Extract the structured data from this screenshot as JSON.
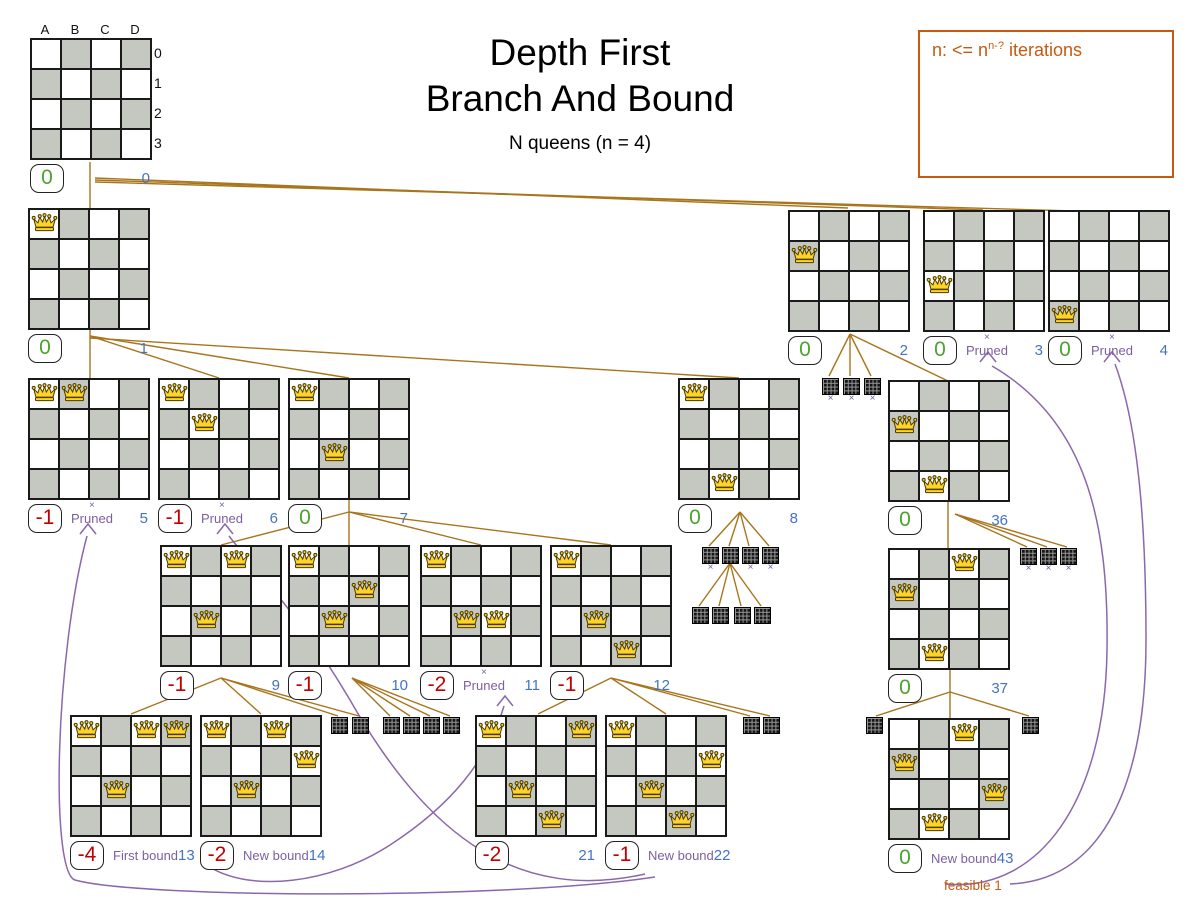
{
  "title": {
    "line1": "Depth First",
    "line2": "Branch And Bound",
    "subtitle": "N queens (n = 4)"
  },
  "legend": {
    "prefix": "n: <= n",
    "sup": "n-?",
    "suffix": " iterations"
  },
  "axis": {
    "cols": [
      "A",
      "B",
      "C",
      "D"
    ],
    "rows": [
      "0",
      "1",
      "2",
      "3"
    ]
  },
  "colors": {
    "edge": "#a9751c",
    "purple": "#8a68ab",
    "labelpurple": "#7d5fa0",
    "blue": "#4472c4",
    "green": "#4ca32e",
    "red": "#c00000",
    "orange": "#c55a11",
    "gray": "#c4c8c0"
  },
  "nodes": [
    {
      "id": "0",
      "x": 30,
      "y": 22,
      "queens": [],
      "score": "0",
      "axes": true
    },
    {
      "id": "1",
      "x": 28,
      "y": 208,
      "queens": [
        [
          0,
          0
        ]
      ],
      "score": "0"
    },
    {
      "id": "2",
      "x": 788,
      "y": 210,
      "queens": [
        [
          0,
          1
        ]
      ],
      "score": "0"
    },
    {
      "id": "3",
      "x": 923,
      "y": 210,
      "queens": [
        [
          0,
          2
        ]
      ],
      "score": "0",
      "label": "Pruned",
      "pruned": true
    },
    {
      "id": "4",
      "x": 1048,
      "y": 210,
      "queens": [
        [
          0,
          3
        ]
      ],
      "score": "0",
      "label": "Pruned",
      "pruned": true
    },
    {
      "id": "5",
      "x": 28,
      "y": 378,
      "queens": [
        [
          0,
          0
        ],
        [
          1,
          0
        ]
      ],
      "score": "-1",
      "label": "Pruned",
      "pruned": true
    },
    {
      "id": "6",
      "x": 158,
      "y": 378,
      "queens": [
        [
          0,
          0
        ],
        [
          1,
          1
        ]
      ],
      "score": "-1",
      "label": "Pruned",
      "pruned": true
    },
    {
      "id": "7",
      "x": 288,
      "y": 378,
      "queens": [
        [
          0,
          0
        ],
        [
          1,
          2
        ]
      ],
      "score": "0"
    },
    {
      "id": "8",
      "x": 678,
      "y": 378,
      "queens": [
        [
          0,
          0
        ],
        [
          1,
          3
        ]
      ],
      "score": "0"
    },
    {
      "id": "36",
      "x": 888,
      "y": 380,
      "queens": [
        [
          0,
          1
        ],
        [
          1,
          3
        ]
      ],
      "score": "0"
    },
    {
      "id": "9",
      "x": 160,
      "y": 545,
      "queens": [
        [
          0,
          0
        ],
        [
          2,
          0
        ],
        [
          1,
          2
        ]
      ],
      "score": "-1"
    },
    {
      "id": "10",
      "x": 288,
      "y": 545,
      "queens": [
        [
          0,
          0
        ],
        [
          2,
          1
        ],
        [
          1,
          2
        ]
      ],
      "score": "-1"
    },
    {
      "id": "11",
      "x": 420,
      "y": 545,
      "queens": [
        [
          0,
          0
        ],
        [
          1,
          2
        ],
        [
          2,
          2
        ]
      ],
      "score": "-2",
      "label": "Pruned",
      "pruned": true
    },
    {
      "id": "12",
      "x": 550,
      "y": 545,
      "queens": [
        [
          0,
          0
        ],
        [
          1,
          2
        ],
        [
          2,
          3
        ]
      ],
      "score": "-1"
    },
    {
      "id": "37",
      "x": 888,
      "y": 548,
      "queens": [
        [
          2,
          0
        ],
        [
          0,
          1
        ],
        [
          1,
          3
        ]
      ],
      "score": "0"
    },
    {
      "id": "13",
      "x": 70,
      "y": 715,
      "queens": [
        [
          0,
          0
        ],
        [
          2,
          0
        ],
        [
          3,
          0
        ],
        [
          1,
          2
        ]
      ],
      "score": "-4",
      "label": "First bound"
    },
    {
      "id": "14",
      "x": 200,
      "y": 715,
      "queens": [
        [
          0,
          0
        ],
        [
          2,
          0
        ],
        [
          3,
          1
        ],
        [
          1,
          2
        ]
      ],
      "score": "-2",
      "label": "New bound"
    },
    {
      "id": "21",
      "x": 475,
      "y": 715,
      "queens": [
        [
          0,
          0
        ],
        [
          3,
          0
        ],
        [
          1,
          2
        ],
        [
          2,
          3
        ]
      ],
      "score": "-2"
    },
    {
      "id": "22",
      "x": 605,
      "y": 715,
      "queens": [
        [
          0,
          0
        ],
        [
          3,
          1
        ],
        [
          1,
          2
        ],
        [
          2,
          3
        ]
      ],
      "score": "-1",
      "label": "New bound"
    },
    {
      "id": "43",
      "x": 888,
      "y": 718,
      "queens": [
        [
          2,
          0
        ],
        [
          0,
          1
        ],
        [
          3,
          2
        ],
        [
          1,
          3
        ]
      ],
      "score": "0",
      "label": "New bound",
      "extra": "feasible 1"
    }
  ],
  "minis": [
    {
      "x": 822,
      "y": 378,
      "px": true
    },
    {
      "x": 843,
      "y": 378,
      "px": true
    },
    {
      "x": 864,
      "y": 378,
      "px": true
    },
    {
      "x": 702,
      "y": 547,
      "px": true
    },
    {
      "x": 722,
      "y": 547,
      "px": false
    },
    {
      "x": 742,
      "y": 547,
      "px": true
    },
    {
      "x": 762,
      "y": 547,
      "px": true
    },
    {
      "x": 692,
      "y": 607,
      "px": false
    },
    {
      "x": 712,
      "y": 607,
      "px": false
    },
    {
      "x": 734,
      "y": 607,
      "px": false
    },
    {
      "x": 754,
      "y": 607,
      "px": false
    },
    {
      "x": 1020,
      "y": 548,
      "px": true
    },
    {
      "x": 1040,
      "y": 548,
      "px": true
    },
    {
      "x": 1060,
      "y": 548,
      "px": true
    },
    {
      "x": 331,
      "y": 717,
      "px": false
    },
    {
      "x": 352,
      "y": 717,
      "px": false
    },
    {
      "x": 383,
      "y": 717,
      "px": false
    },
    {
      "x": 403,
      "y": 717,
      "px": false
    },
    {
      "x": 423,
      "y": 717,
      "px": false
    },
    {
      "x": 443,
      "y": 717,
      "px": false
    },
    {
      "x": 743,
      "y": 717,
      "px": false
    },
    {
      "x": 763,
      "y": 717,
      "px": false
    },
    {
      "x": 866,
      "y": 717,
      "px": false
    },
    {
      "x": 1022,
      "y": 717,
      "px": false
    }
  ],
  "edges": [
    [
      90,
      162,
      90,
      378
    ],
    [
      95,
      178,
      848,
      208
    ],
    [
      95,
      180,
      983,
      210
    ],
    [
      95,
      182,
      1108,
      212
    ],
    [
      90,
      336,
      219,
      378
    ],
    [
      90,
      336,
      349,
      378
    ],
    [
      90,
      338,
      739,
      378
    ],
    [
      850,
      334,
      829,
      376
    ],
    [
      850,
      334,
      850,
      376
    ],
    [
      850,
      334,
      871,
      376
    ],
    [
      850,
      334,
      948,
      381
    ],
    [
      349,
      512,
      221,
      545
    ],
    [
      349,
      500,
      349,
      545
    ],
    [
      349,
      512,
      481,
      545
    ],
    [
      349,
      512,
      611,
      545
    ],
    [
      740,
      512,
      709,
      546
    ],
    [
      740,
      512,
      729,
      546
    ],
    [
      740,
      512,
      749,
      546
    ],
    [
      740,
      512,
      769,
      546
    ],
    [
      730,
      563,
      699,
      606
    ],
    [
      730,
      563,
      719,
      606
    ],
    [
      730,
      563,
      741,
      606
    ],
    [
      730,
      563,
      761,
      606
    ],
    [
      948,
      502,
      948,
      548
    ],
    [
      955,
      514,
      1027,
      547
    ],
    [
      955,
      514,
      1047,
      547
    ],
    [
      955,
      514,
      1067,
      547
    ],
    [
      221,
      678,
      131,
      714
    ],
    [
      221,
      678,
      261,
      714
    ],
    [
      221,
      678,
      338,
      716
    ],
    [
      221,
      678,
      359,
      716
    ],
    [
      352,
      678,
      390,
      716
    ],
    [
      352,
      678,
      410,
      716
    ],
    [
      352,
      678,
      430,
      716
    ],
    [
      352,
      678,
      450,
      716
    ],
    [
      611,
      678,
      538,
      714
    ],
    [
      611,
      678,
      666,
      714
    ],
    [
      611,
      678,
      750,
      716
    ],
    [
      611,
      678,
      770,
      716
    ],
    [
      950,
      670,
      950,
      718
    ],
    [
      950,
      692,
      876,
      716
    ],
    [
      950,
      692,
      1029,
      716
    ]
  ],
  "purple_curves": [
    "M 208 866 C 250 893 330 884 390 845 C 450 806 487 762 504 706",
    "M 645 874 C 520 902 430 840 350 700 C 300 615 255 570 229 536",
    "M 655 877 C 500 900 140 898 75 880 C 50 872 55 655 87 536",
    "M 945 884 C 1040 893 1105 800 1107 650 C 1109 520 1085 420 992 366",
    "M 1010 884 C 1105 880 1146 780 1146 640 C 1146 510 1136 420 1115 364"
  ],
  "chevrons": [
    [
      88,
      524
    ],
    [
      225,
      524
    ],
    [
      505,
      696
    ],
    [
      988,
      352
    ],
    [
      1112,
      352
    ]
  ]
}
